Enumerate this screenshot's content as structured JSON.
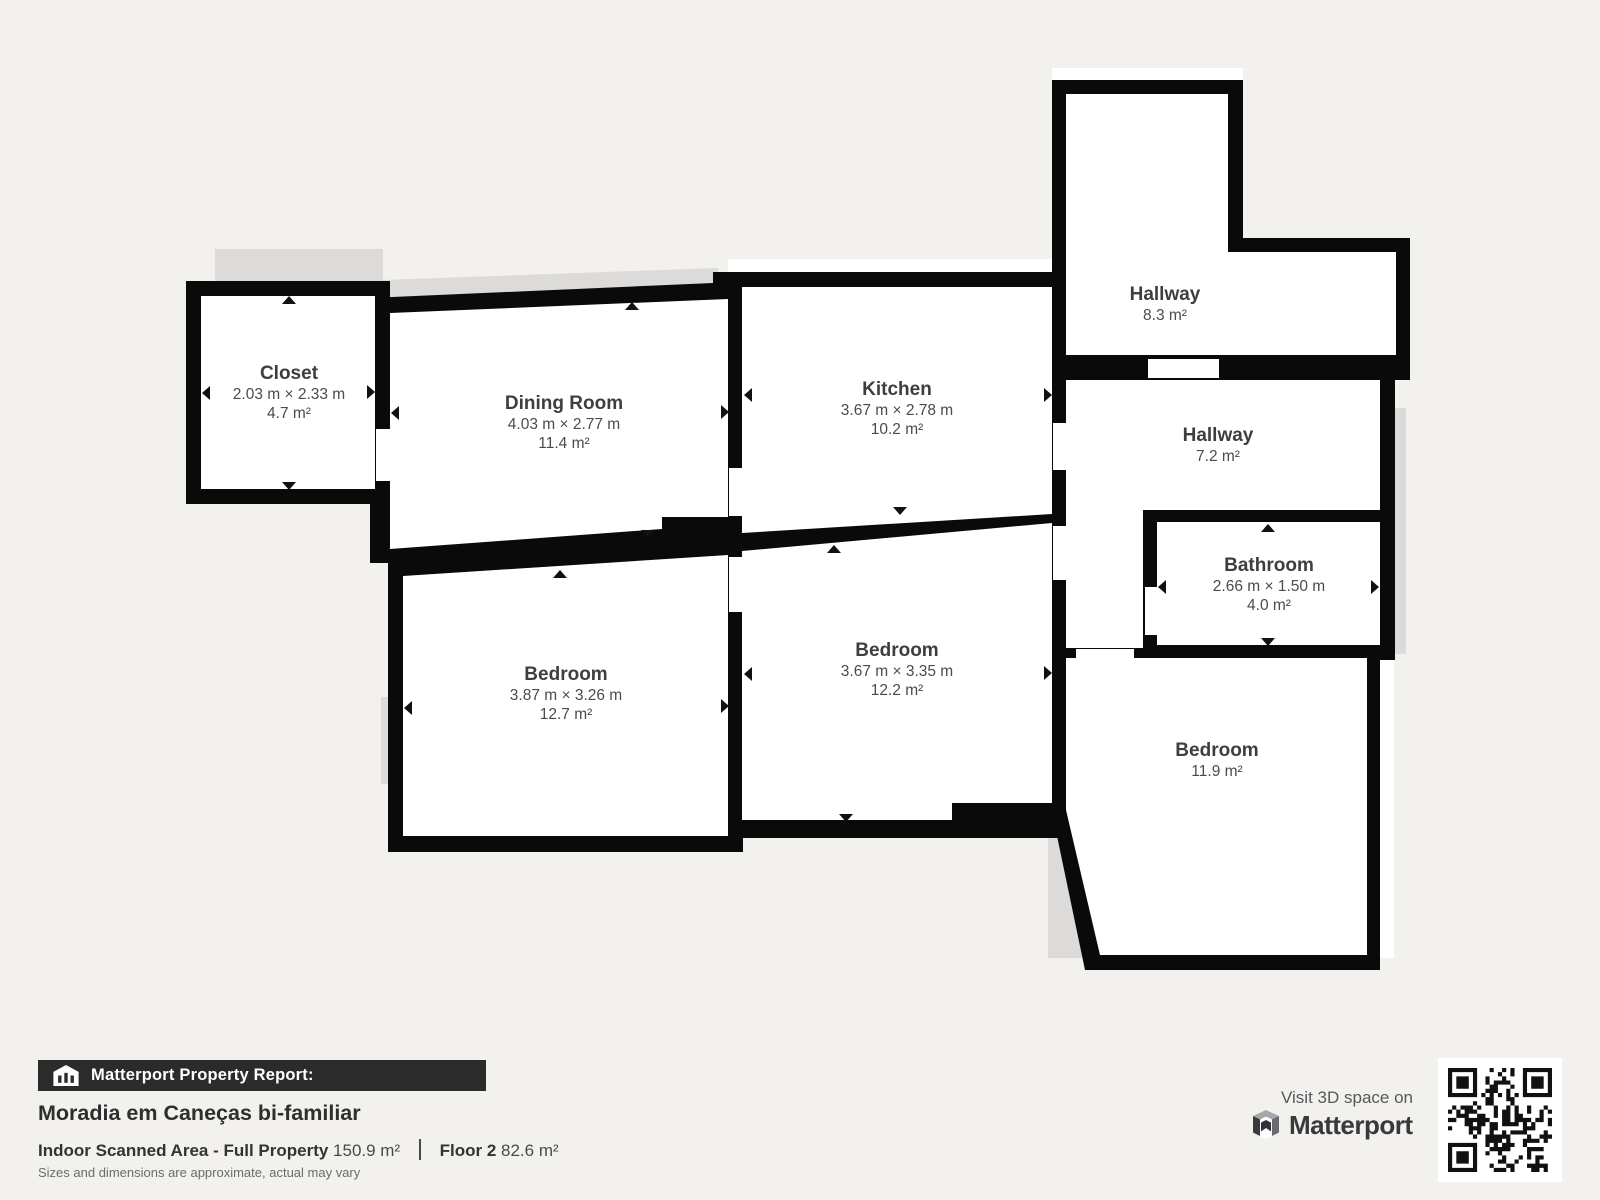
{
  "page": {
    "background_color": "#f3f1ee",
    "wall_color": "#0a0a0a",
    "room_color": "#ffffff",
    "shadow_color": "#dcdbd9"
  },
  "rooms": [
    {
      "id": "closet",
      "name": "Closet",
      "dims": "2.03 m × 2.33 m",
      "area": "4.7 m²"
    },
    {
      "id": "dining-room",
      "name": "Dining Room",
      "dims": "4.03 m × 2.77 m",
      "area": "11.4 m²"
    },
    {
      "id": "kitchen",
      "name": "Kitchen",
      "dims": "3.67 m × 2.78 m",
      "area": "10.2 m²"
    },
    {
      "id": "hallway-upper",
      "name": "Hallway",
      "area": "8.3 m²"
    },
    {
      "id": "hallway-lower",
      "name": "Hallway",
      "area": "7.2 m²"
    },
    {
      "id": "bathroom",
      "name": "Bathroom",
      "dims": "2.66 m × 1.50 m",
      "area": "4.0 m²"
    },
    {
      "id": "bedroom-left",
      "name": "Bedroom",
      "dims": "3.87 m × 3.26 m",
      "area": "12.7 m²"
    },
    {
      "id": "bedroom-middle",
      "name": "Bedroom",
      "dims": "3.67 m × 3.35 m",
      "area": "12.2 m²"
    },
    {
      "id": "bedroom-right",
      "name": "Bedroom",
      "area": "11.9 m²"
    }
  ],
  "footer": {
    "report_label": "Matterport Property Report:",
    "property_title": "Moradia em Caneças bi-familiar",
    "area_label": "Indoor Scanned Area - Full Property",
    "area_value": "150.9 m²",
    "floor_label": "Floor 2",
    "floor_value": "82.6 m²",
    "disclaimer": "Sizes and dimensions are approximate, actual may vary"
  },
  "branding": {
    "visit_label": "Visit 3D space on",
    "brand_name": "Matterport"
  }
}
